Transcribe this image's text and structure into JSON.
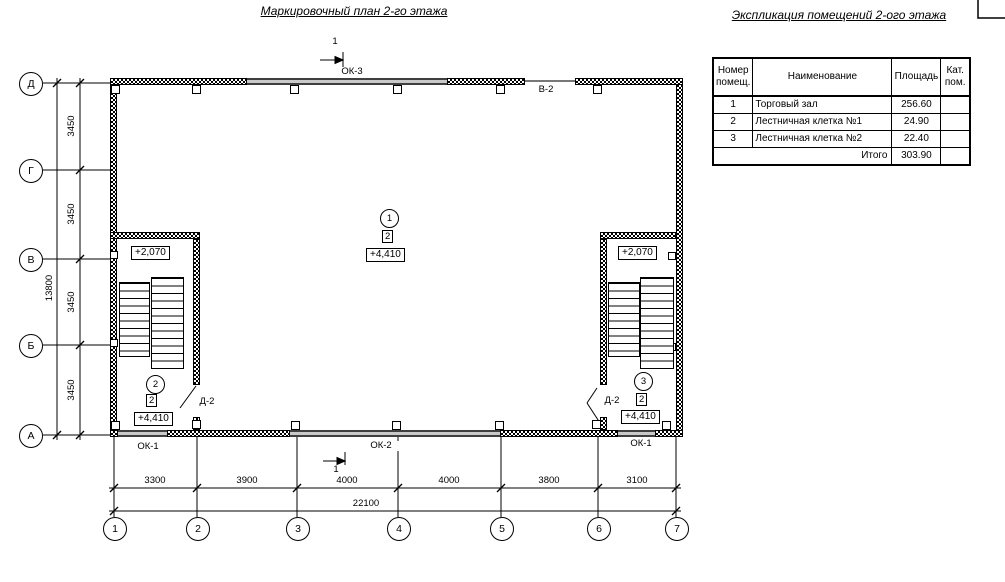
{
  "titles": {
    "plan": "Маркировочный план 2-го этажа",
    "explication": "Экспликация помещений 2-ого этажа"
  },
  "explication_table": {
    "headers": [
      "Номер помещ.",
      "Наименование",
      "Площадь",
      "Кат. пом."
    ],
    "rows": [
      {
        "num": "1",
        "name": "Торговый зал",
        "area": "256.60",
        "cat": ""
      },
      {
        "num": "2",
        "name": "Лестничная клетка №1",
        "area": "24.90",
        "cat": ""
      },
      {
        "num": "3",
        "name": "Лестничная клетка №2",
        "area": "22.40",
        "cat": ""
      }
    ],
    "total_label": "Итого",
    "total_value": "303.90"
  },
  "axes": {
    "rows": [
      "Д",
      "Г",
      "В",
      "Б",
      "А"
    ],
    "cols": [
      "1",
      "2",
      "3",
      "4",
      "5",
      "6",
      "7"
    ]
  },
  "dims": {
    "v_total": "13800",
    "v_segs": [
      "3450",
      "3450",
      "3450",
      "3450"
    ],
    "h_segs": [
      "3300",
      "3900",
      "4000",
      "4000",
      "3800",
      "3100"
    ],
    "h_total": "22100"
  },
  "marks": {
    "ok1_left": "ОК-1",
    "ok2": "ОК-2",
    "ok1_right": "ОК-1",
    "ok3": "ОК-3",
    "v2": "В-2",
    "d2_left": "Д-2",
    "d2_right": "Д-2",
    "section_top": "1",
    "section_bottom": "1"
  },
  "rooms": {
    "hall": {
      "num": "1",
      "cat": "2",
      "level": "+4,410"
    },
    "stair_left": {
      "num": "2",
      "cat": "2",
      "level": "+4,410",
      "upper": "+2,070"
    },
    "stair_right": {
      "num": "3",
      "cat": "2",
      "level": "+4,410",
      "upper": "+2,070"
    }
  }
}
